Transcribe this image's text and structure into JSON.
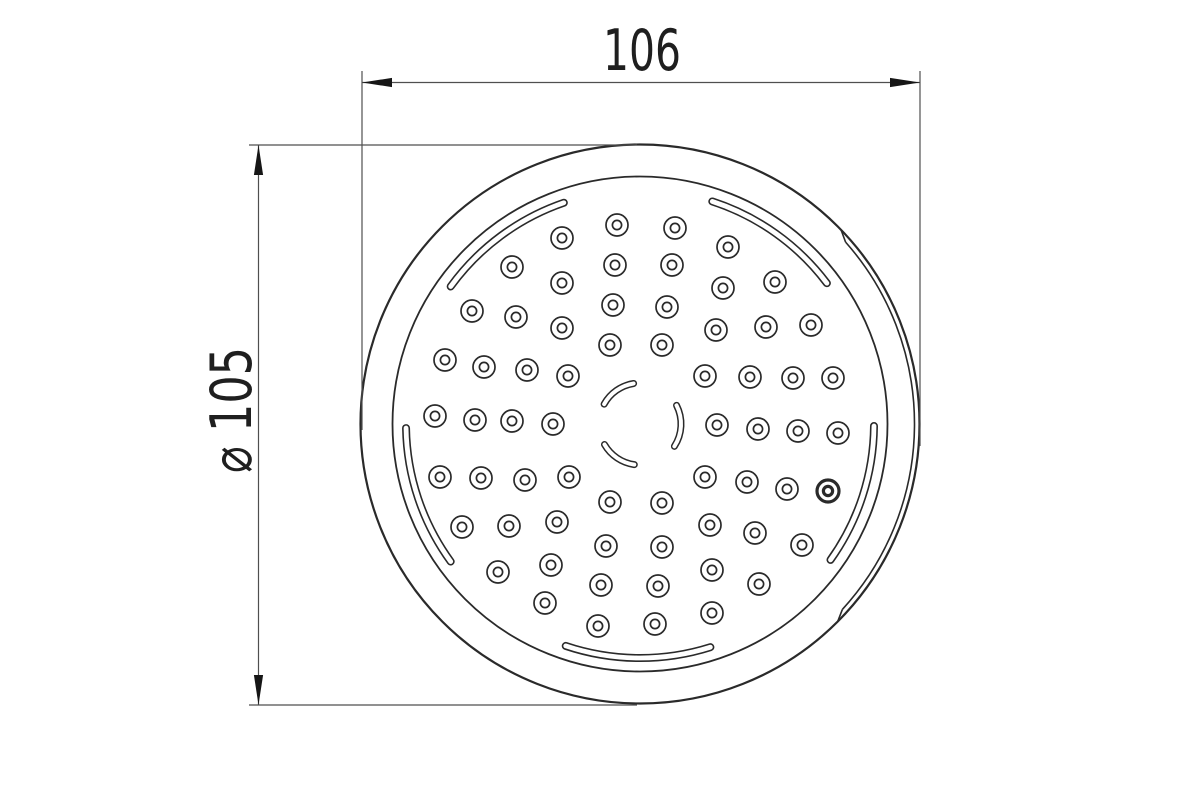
{
  "drawing": {
    "description": "technical-drawing-showerhead-faceplate",
    "canvas": {
      "width": 1200,
      "height": 799
    },
    "colors": {
      "background": "#ffffff",
      "geometry": "#2a2a2a",
      "dimension_line": "#4f4f4f",
      "arrow_fill": "#161616",
      "text": "#1f1f1f",
      "slot_fill": "#ffffff"
    },
    "plate": {
      "center": {
        "x": 640,
        "y": 424
      },
      "outer_circle": {
        "r": 279.5,
        "stroke_w": 2.2
      },
      "inner_circle": {
        "r": 247.5,
        "stroke_w": 1.8
      },
      "rim_seam_arc": {
        "r": 274.5,
        "start_deg": -42.5,
        "end_deg": 41.5,
        "stroke_w": 1.6,
        "connect_r": 279.5,
        "connect_overshoot_deg": 2.5
      },
      "rim_slots": {
        "r": 234,
        "outer_w": 8,
        "inner_w": 4.8,
        "spans_deg": [
          [
            37,
            72
          ],
          [
            109,
            144
          ],
          [
            181,
            216
          ],
          [
            251.5,
            287.5
          ],
          [
            324.5,
            359.5
          ]
        ]
      },
      "center_slots": {
        "r": 41,
        "outer_w": 7,
        "inner_w": 4,
        "spans_deg": [
          [
            99,
            151
          ],
          [
            -33,
            27
          ],
          [
            210,
            262
          ]
        ]
      },
      "holes": {
        "outer_r": 11,
        "inner_r": 4.6,
        "stroke_w": 1.7,
        "bold_stroke_w": 3.2,
        "bold_index": 43,
        "centers": [
          [
            617,
            225
          ],
          [
            675,
            228
          ],
          [
            562,
            238
          ],
          [
            728,
            247
          ],
          [
            512,
            267
          ],
          [
            615,
            265
          ],
          [
            672,
            265
          ],
          [
            775,
            282
          ],
          [
            562,
            283
          ],
          [
            723,
            288
          ],
          [
            472,
            311
          ],
          [
            613,
            305
          ],
          [
            667,
            307
          ],
          [
            811,
            325
          ],
          [
            516,
            317
          ],
          [
            766,
            327
          ],
          [
            716,
            330
          ],
          [
            562,
            328
          ],
          [
            662,
            345
          ],
          [
            610,
            345
          ],
          [
            445,
            360
          ],
          [
            484,
            367
          ],
          [
            527,
            370
          ],
          [
            568,
            376
          ],
          [
            705,
            376
          ],
          [
            750,
            377
          ],
          [
            793,
            378
          ],
          [
            833,
            378
          ],
          [
            435,
            416
          ],
          [
            475,
            420
          ],
          [
            512,
            421
          ],
          [
            553,
            424
          ],
          [
            717,
            425
          ],
          [
            758,
            429
          ],
          [
            798,
            431
          ],
          [
            838,
            433
          ],
          [
            440,
            477
          ],
          [
            481,
            478
          ],
          [
            525,
            480
          ],
          [
            569,
            477
          ],
          [
            705,
            477
          ],
          [
            747,
            482
          ],
          [
            787,
            489
          ],
          [
            828,
            491
          ],
          [
            462,
            527
          ],
          [
            509,
            526
          ],
          [
            557,
            522
          ],
          [
            610,
            502
          ],
          [
            662,
            503
          ],
          [
            710,
            525
          ],
          [
            755,
            533
          ],
          [
            802,
            545
          ],
          [
            498,
            572
          ],
          [
            551,
            565
          ],
          [
            606,
            546
          ],
          [
            662,
            547
          ],
          [
            712,
            570
          ],
          [
            759,
            584
          ],
          [
            545,
            603
          ],
          [
            601,
            585
          ],
          [
            658,
            586
          ],
          [
            712,
            613
          ],
          [
            598,
            626
          ],
          [
            655,
            624
          ]
        ]
      }
    },
    "dimensions": {
      "horizontal": {
        "label": "106",
        "line": {
          "y": 82.5,
          "x1": 362,
          "x2": 920
        },
        "extension_left": {
          "x": 362,
          "y1": 71,
          "y2": 430
        },
        "extension_right": {
          "x": 920,
          "y1": 71,
          "y2": 446
        },
        "label_pos": {
          "x": 642,
          "y": 70
        },
        "label_length": 78,
        "arrow_len": 30,
        "arrow_half_w": 4.6
      },
      "vertical": {
        "label": "⌀ 105",
        "line": {
          "x": 258.5,
          "y1": 145,
          "y2": 705
        },
        "extension_top": {
          "y": 145,
          "x1": 249,
          "x2": 637
        },
        "extension_bottom": {
          "y": 705,
          "x1": 249,
          "x2": 637
        },
        "label_pos": {
          "x": 251,
          "y": 410
        },
        "label_length": 126,
        "arrow_len": 30,
        "arrow_half_w": 4.6
      },
      "font_size": 57
    }
  }
}
